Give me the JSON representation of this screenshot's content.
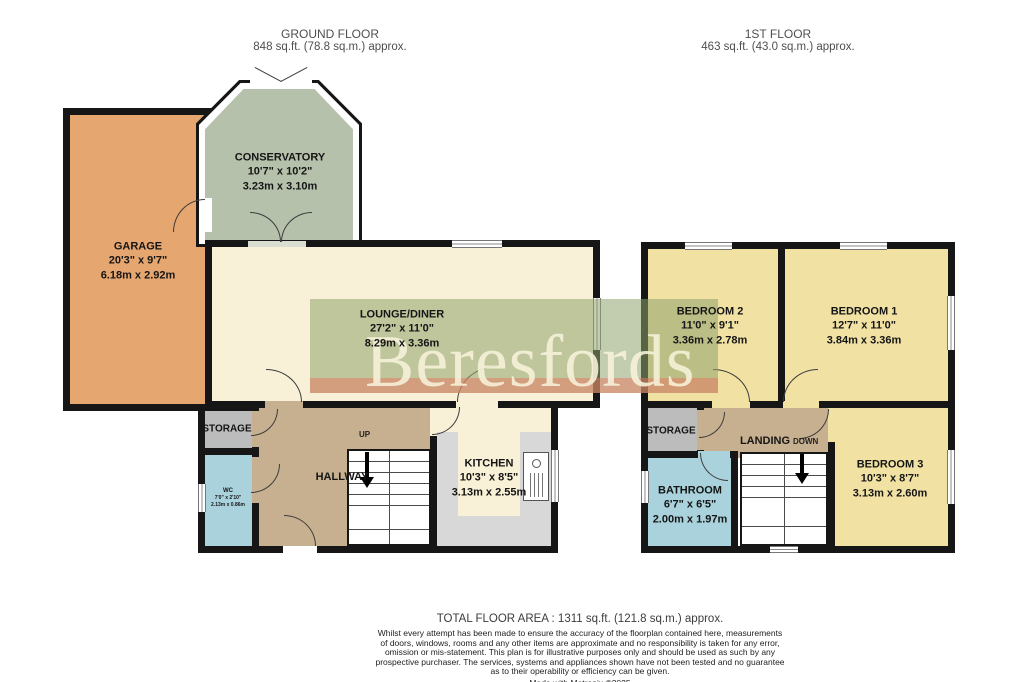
{
  "headers": {
    "ground": {
      "title": "GROUND FLOOR",
      "area": "848 sq.ft. (78.8 sq.m.) approx."
    },
    "first": {
      "title": "1ST FLOOR",
      "area": "463 sq.ft. (43.0 sq.m.) approx."
    }
  },
  "watermark": {
    "text": "Beresfords"
  },
  "rooms": {
    "garage": {
      "name": "GARAGE",
      "size_ft": "20'3\" x 9'7\"",
      "size_m": "6.18m x 2.92m"
    },
    "conservatory": {
      "name": "CONSERVATORY",
      "size_ft": "10'7\" x 10'2\"",
      "size_m": "3.23m x 3.10m"
    },
    "lounge": {
      "name": "LOUNGE/DINER",
      "size_ft": "27'2\" x 11'0\"",
      "size_m": "8.29m x 3.36m"
    },
    "kitchen": {
      "name": "KITCHEN",
      "size_ft": "10'3\" x 8'5\"",
      "size_m": "3.13m x 2.55m"
    },
    "hallway": {
      "name": "HALLWAY"
    },
    "storage_ground": {
      "name": "STORAGE"
    },
    "wc": {
      "name": "WC",
      "size_ft": "7'0\" x 2'10\"",
      "size_m": "2.13m x 0.86m"
    },
    "bedroom1": {
      "name": "BEDROOM 1",
      "size_ft": "12'7\" x 11'0\"",
      "size_m": "3.84m x 3.36m"
    },
    "bedroom2": {
      "name": "BEDROOM 2",
      "size_ft": "11'0\" x 9'1\"",
      "size_m": "3.36m x 2.78m"
    },
    "bedroom3": {
      "name": "BEDROOM 3",
      "size_ft": "10'3\" x 8'7\"",
      "size_m": "3.13m x 2.60m"
    },
    "storage_first": {
      "name": "STORAGE"
    },
    "landing": {
      "name": "LANDING"
    },
    "bathroom": {
      "name": "BATHROOM",
      "size_ft": "6'7\" x 6'5\"",
      "size_m": "2.00m x 1.97m"
    }
  },
  "stairs": {
    "up": "UP",
    "down": "DOWN"
  },
  "footer": {
    "total": "TOTAL FLOOR AREA : 1311 sq.ft. (121.8 sq.m.) approx.",
    "disclaimer_lines": [
      "Whilst every attempt has been made to ensure the accuracy of the floorplan contained here, measurements",
      "of doors, windows, rooms and any other items are approximate and no responsibility is taken for any error,",
      "omission or mis-statement. This plan is for illustrative purposes only and should be used as such by any",
      "prospective purchaser. The services, systems and appliances shown have not been tested and no guarantee",
      "as to their operability or efficiency can be given."
    ],
    "credit": "Made with Metropix ©2025"
  },
  "colors": {
    "wall": "#161616",
    "garage_fill": "#e5a670",
    "conservatory_fill": "#b6c1ab",
    "lounge_fill": "#f8f1d7",
    "bedroom_fill": "#f1e2a4",
    "hall_fill": "#c7b08f",
    "storage_fill": "#bcbcbc",
    "bath_fill": "#a9d2dc",
    "counter_fill": "#d8d8d8",
    "watermark_green": "#8fa26c",
    "watermark_pink": "#e87660",
    "watermark_text": "#f7f3db"
  }
}
